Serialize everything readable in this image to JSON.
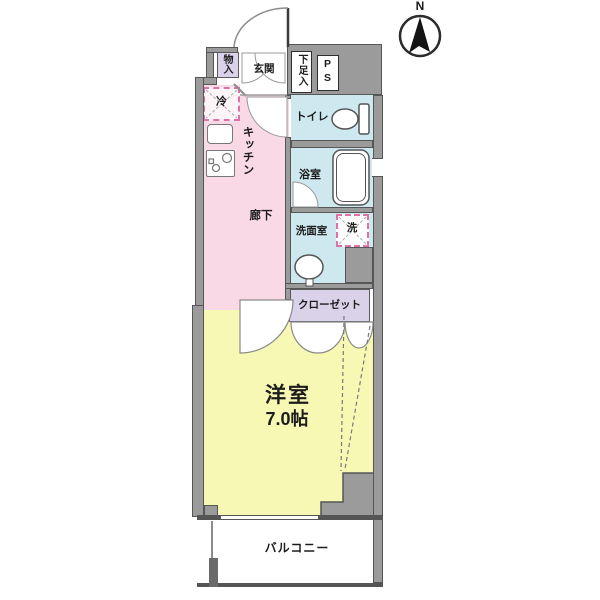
{
  "title": "apartment-floor-plan",
  "compass": {
    "label": "N"
  },
  "rooms": {
    "storage": {
      "label": "物入"
    },
    "entrance": {
      "label": "玄関"
    },
    "shoe_cabinet": {
      "label": "下足入"
    },
    "pipe_space": {
      "label": "PS"
    },
    "refrigerator": {
      "label": "冷"
    },
    "kitchen": {
      "label": "キッチン"
    },
    "corridor": {
      "label": "廊下"
    },
    "toilet": {
      "label": "トイレ"
    },
    "bathroom": {
      "label": "浴室"
    },
    "washroom": {
      "label": "洗面室"
    },
    "washer": {
      "label": "洗"
    },
    "closet": {
      "label": "クローゼット"
    },
    "western_room": {
      "label": "洋室",
      "size": "7.0帖"
    },
    "balcony": {
      "label": "バルコニー"
    }
  },
  "colors": {
    "wall": "#9b9b9b",
    "kitchen_floor": "#f8d9e5",
    "wet_area_floor": "#cde8ee",
    "closet_floor": "#d9d2e9",
    "room_floor": "#f8f8b5",
    "dashed_accent": "#e070a8"
  }
}
